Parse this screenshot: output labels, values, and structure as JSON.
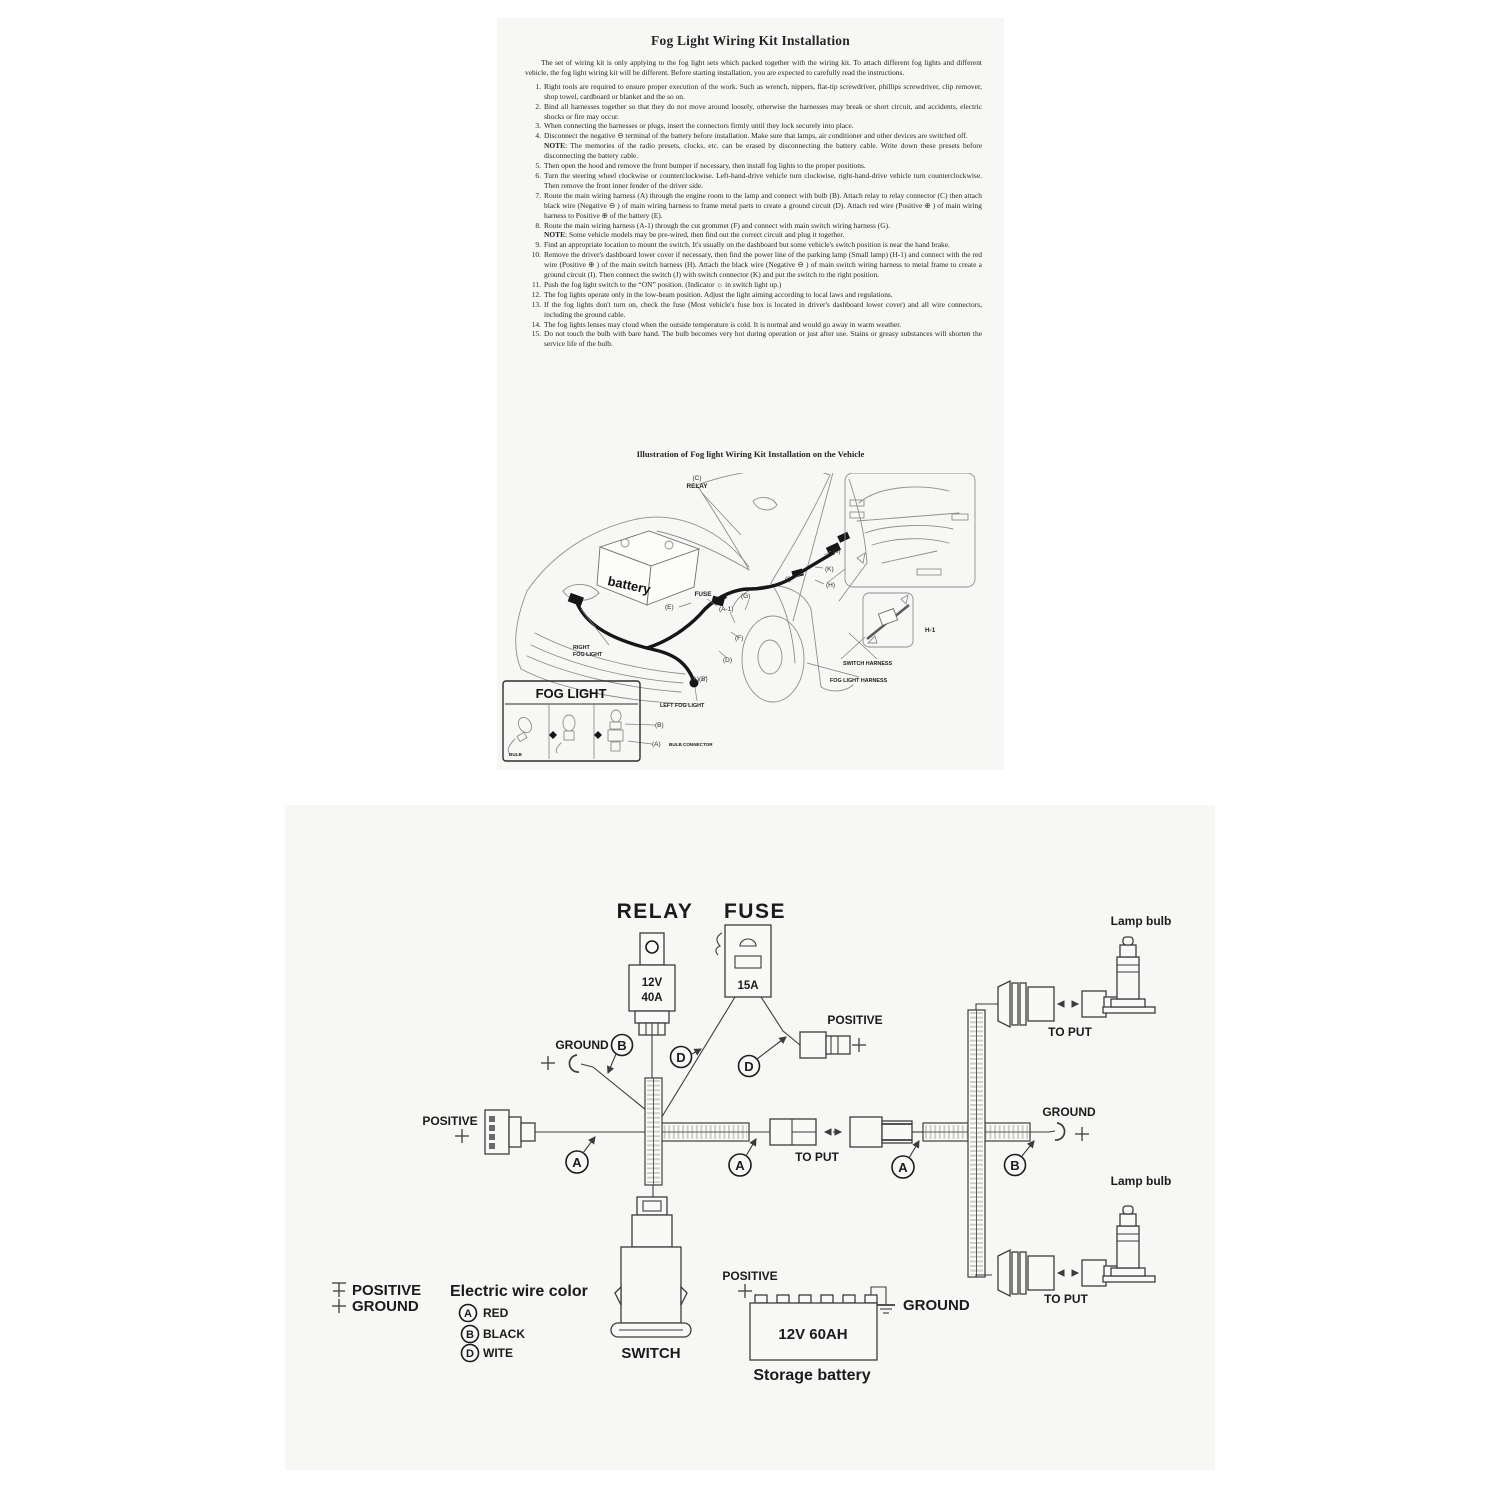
{
  "colors": {
    "sheet_bg": "#f7f7f5",
    "ink": "#262626",
    "diagram_line": "#3c3c3c"
  },
  "sheet1": {
    "title": "Fog Light Wiring Kit Installation",
    "intro": "The set of wiring kit is only applying to the fog light sets which packed together with the wiring kit.  To attach different fog lights and different vehicle, the fog light wiring kit will be different.  Before starting installation, you are expected to carefully read the instructions.",
    "items": [
      {
        "no": "1.",
        "text": "Right tools are required to ensure proper execution of the work.  Such as wrench, nippers, flat-tip screwdriver, phillips screwdriver, clip remover, shop towel, cardboard or blanket and the so on."
      },
      {
        "no": "2.",
        "text": "Bind all harnesses together so that they do not move around loosely, otherwise the harnesses may break or short circuit, and accidents, electric shocks or fire may occur."
      },
      {
        "no": "3.",
        "text": "When connecting the harnesses or plugs, insert the connectors firmly until they lock securely into place."
      },
      {
        "no": "4.",
        "text": "Disconnect the negative ⊖ terminal of the battery before installation.  Make sure that lamps, air conditioner and other devices are switched off.",
        "note_label": "NOTE",
        "note": ": The memories of the radio presets, clocks, etc. can be erased by disconnecting the battery cable.  Write down these presets before disconnecting the battery cable."
      },
      {
        "no": "5.",
        "text": "Then open the hood and remove the front bumper if necessary, then install fog lights to the proper positions."
      },
      {
        "no": "6.",
        "text": "Turn the steering wheel clockwise or counterclockwise. Left-hand-drive vehicle turn clockwise, right-hand-drive vehicle turn counterclockwise. Then remove the front inner fender of the driver side."
      },
      {
        "no": "7.",
        "text": "Route the main wiring harness (A) through the engine room to the lamp and connect with bulb (B).  Attach relay to relay connector (C) then attach black wire (Negative ⊖ ) of main wiring harness to frame metal parts to create a ground circuit (D). Attach red wire (Positive ⊕ ) of main wiring harness to Positive ⊕ of the battery (E)."
      },
      {
        "no": "8.",
        "text": "Route the main wiring harness (A-1) through the cut grommet (F) and connect with main switch wiring harness (G).",
        "note_label": "NOTE",
        "note": ": Some vehicle models may be pre-wired, then find out the correct circuit and plug it together."
      },
      {
        "no": "9.",
        "text": "Find an appropriate location to mount the switch. It's usually on the dashboard but some vehicle's switch position is near the hand brake."
      },
      {
        "no": "10.",
        "text": "Remove the driver's dashboard lower cover if necessary, then find the power line of the parking lamp (Small lamp) (H-1) and connect with the red wire (Positive ⊕ ) of the main switch harness (H). Attach the black wire (Negative ⊖ ) of main switch wiring harness to metal frame to create a ground circuit (I). Then connect the switch (J) with switch connector (K) and put the switch to the right position."
      },
      {
        "no": "11.",
        "text": "Push the fog light switch to the “ON” position. (Indicator ☼ in switch light up.)"
      },
      {
        "no": "12.",
        "text": "The fog lights operate only in the low-beam position. Adjust the light aiming according to local laws and regulations."
      },
      {
        "no": "13.",
        "text": "If the fog lights don't turn on, check the fuse (Most vehicle's fuse box is located in driver's dashboard lower cover) and all wire connectors, including the ground cable."
      },
      {
        "no": "14.",
        "text": "The fog lights lenses may cloud when the outside temperature is cold. It is normal and would go away in warm weather."
      },
      {
        "no": "15.",
        "text": "Do not touch the bulb with bare hand.  The bulb becomes very hot during operation or just after use.  Stains or greasy substances will shorten the service life of the bulb."
      }
    ],
    "illustration_title": "Illustration of Fog light Wiring Kit Installation on the Vehicle",
    "labels": {
      "c": "(C)",
      "relay": "RELAY",
      "battery": "battery",
      "fuse": "FUSE",
      "e": "(E)",
      "a1": "(A-1)",
      "g": "(G)",
      "j": "(J)",
      "k": "(K)",
      "i": "(I)",
      "h": "(H)",
      "d": "(D)",
      "f": "(F)",
      "ab": "(A)(B)",
      "right_fog_line1": "RIGHT",
      "right_fog_line2": "FOG LIGHT",
      "switch_harness": "SWITCH HARNESS",
      "fog_light_harness": "FOG LIGHT HARNESS",
      "left_fog": "LEFT  FOG LIGHT",
      "h1": "H-1",
      "box_title": "FOG LIGHT",
      "bulb": "BULB",
      "b": "(B)",
      "a": "(A)",
      "bulb_connector": "BULB CONNECTOR"
    }
  },
  "sheet2": {
    "relay_title": "RELAY",
    "fuse_title": "FUSE",
    "relay_volts": "12V",
    "relay_amps": "40A",
    "fuse_amps": "15A",
    "positive": "POSITIVE",
    "ground": "GROUND",
    "to_put": "TO PUT",
    "lamp_bulb": "Lamp bulb",
    "switch_label": "SWITCH",
    "battery_rating": "12V  60AH",
    "battery_label": "Storage battery",
    "legend_title": "Electric wire color",
    "legend": {
      "positive": "POSITIVE",
      "ground": "GROUND",
      "a": "A",
      "a_color": "RED",
      "b": "B",
      "b_color": "BLACK",
      "d": "D",
      "d_color": "WITE"
    },
    "code_a": "A",
    "code_b": "B",
    "code_d": "D"
  }
}
